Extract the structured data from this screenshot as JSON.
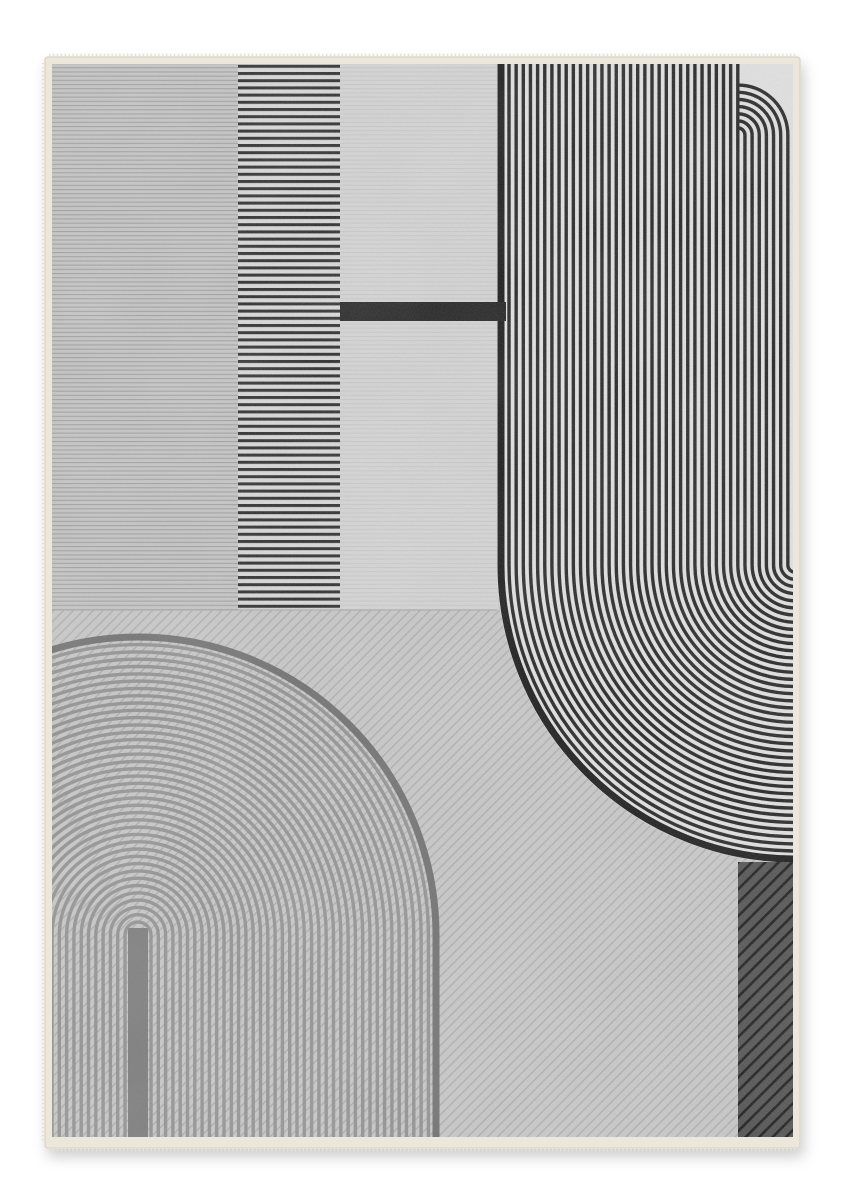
{
  "page": {
    "background": "#ffffff",
    "canvas": {
      "width": 846,
      "height": 1200
    }
  },
  "rug": {
    "binding": {
      "x": 45,
      "y": 57,
      "width": 755,
      "height": 1091,
      "color": "#ece7db",
      "edge_color": "#ddd7c8",
      "fringe_color": "#e7e1d3"
    },
    "content": {
      "x": 52,
      "y": 64,
      "width": 741,
      "height": 1073,
      "base_color": "#cccccc"
    },
    "upper": {
      "bottom": 610,
      "seam_color": "#adadad",
      "panel_left": {
        "x": 52,
        "width": 186,
        "bg": "#c6c6c6",
        "line_color": "#a0a0a0",
        "line_period": 4.2,
        "line_w": 1.1
      },
      "stripe_band": {
        "x": 238,
        "width": 102,
        "bg": "#dadada",
        "stripe_color": "#272727",
        "period": 7.2,
        "stripe_h": 3.0
      },
      "panel_mid": {
        "x": 340,
        "width": 158,
        "bg": "#d6d6d6",
        "line_color": "#c9c9c9",
        "line_period": 4.2,
        "line_w": 1.0
      },
      "accent_bar": {
        "x": 340,
        "y": 302,
        "width": 166,
        "height": 19,
        "color": "#1d1d1d"
      }
    },
    "lower": {
      "y": 610,
      "bg": "#c9c9c9",
      "diag_line_color": "#adadad",
      "diag_period": 7.0,
      "diag_line_w": 1.3
    },
    "right_motif": {
      "left": 497,
      "right": 793,
      "top": 64,
      "bend_y": 565,
      "center_x": 795,
      "corner_cx": 738,
      "corner_cy": 135,
      "bg": "#e3e3e3",
      "stripe_color": "#1f1f1f",
      "stripe_w": 3.4,
      "first_stripe_x": 509,
      "period": 7.15,
      "count": 40,
      "boundary_color": "#141414",
      "boundary_w": 7,
      "boundary_x": 501
    },
    "arch": {
      "cx": 138,
      "cy": 935,
      "bottom": 1137,
      "r_min": 13,
      "period": 7.3,
      "count": 39,
      "stripe_color": "#929292",
      "stripe_w": 3.4,
      "outer_r": 298,
      "outer_color": "#6f6f6f",
      "outer_w": 7,
      "center_bar": {
        "x": 128,
        "y": 928,
        "width": 20,
        "color": "#7b7b7b"
      }
    },
    "corner_block": {
      "x": 738,
      "y": 862,
      "width": 55,
      "height": 275,
      "bg": "#4d4d4d",
      "stripe_color": "#151515",
      "period": 9.5,
      "stripe_w": 2.6
    },
    "texture": {
      "grain_gray": "0.42",
      "grain_opacity": 0.3,
      "cloud_gray": "0.95",
      "cloud_opacity": 0.1
    },
    "shadow": {
      "dx": 3,
      "dy": 8,
      "blur": 7,
      "opacity": 0.2
    }
  }
}
